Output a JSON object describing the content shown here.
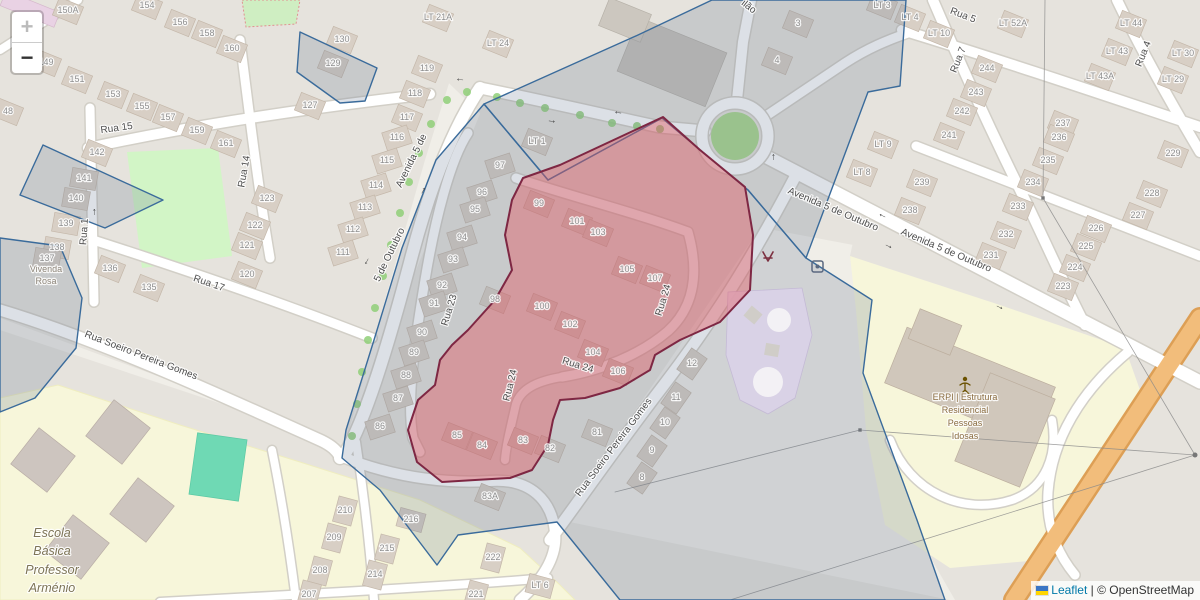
{
  "controls": {
    "zoom_in": "+",
    "zoom_out": "−"
  },
  "attribution": {
    "leaflet": "Leaflet",
    "sep": " | ",
    "osm": "© OpenStreetMap"
  },
  "colors": {
    "red_fill": "#e2565f",
    "red_stroke": "#7e2743",
    "blue_stroke": "#3a6b9b",
    "blue_fill": "rgba(96,115,140,0.22)",
    "purple_fill": "#dbd3e8",
    "link": "#0078A8",
    "house_number_text": "#8f8f8f",
    "street_text": "#4e4e4e"
  },
  "house_numbers": [
    [
      "150A",
      68,
      10,
      22
    ],
    [
      "154",
      147,
      5,
      22
    ],
    [
      "156",
      180,
      22,
      22
    ],
    [
      "158",
      207,
      33,
      22
    ],
    [
      "160",
      232,
      48,
      22
    ],
    [
      "149",
      46,
      62,
      22
    ],
    [
      "151",
      77,
      79,
      22
    ],
    [
      "153",
      113,
      94,
      22
    ],
    [
      "155",
      142,
      106,
      22
    ],
    [
      "157",
      168,
      117,
      22
    ],
    [
      "159",
      197,
      130,
      22
    ],
    [
      "161",
      226,
      143,
      22
    ],
    [
      "48",
      8,
      111,
      22
    ],
    [
      "142",
      97,
      152,
      22
    ],
    [
      "141",
      84,
      178,
      10
    ],
    [
      "140",
      76,
      198,
      10
    ],
    [
      "139",
      66,
      223,
      10
    ],
    [
      "138",
      57,
      247,
      10
    ],
    [
      "137",
      47,
      258,
      10
    ],
    [
      "136",
      110,
      268,
      22
    ],
    [
      "135",
      149,
      287,
      22
    ],
    [
      "123",
      267,
      198,
      22
    ],
    [
      "122",
      255,
      225,
      22
    ],
    [
      "121",
      247,
      245,
      22
    ],
    [
      "120",
      247,
      274,
      22
    ],
    [
      "130",
      342,
      39,
      22
    ],
    [
      "129",
      333,
      63,
      22
    ],
    [
      "127",
      310,
      105,
      22
    ],
    [
      "LT 21A",
      438,
      17,
      22
    ],
    [
      "LT 24",
      498,
      43,
      22
    ],
    [
      "119",
      427,
      68,
      22
    ],
    [
      "118",
      415,
      93,
      22
    ],
    [
      "117",
      407,
      117,
      22
    ],
    [
      "116",
      397,
      137,
      -18
    ],
    [
      "115",
      387,
      160,
      -18
    ],
    [
      "114",
      376,
      185,
      -18
    ],
    [
      "113",
      365,
      207,
      -18
    ],
    [
      "112",
      353,
      229,
      -18
    ],
    [
      "111",
      343,
      252,
      -18
    ],
    [
      "LT 1",
      537,
      141,
      22
    ],
    [
      "3",
      798,
      23,
      22
    ],
    [
      "4",
      777,
      60,
      22
    ],
    [
      "LT 3",
      882,
      5,
      22
    ],
    [
      "LT 9",
      883,
      144,
      22
    ],
    [
      "LT 8",
      862,
      172,
      22
    ],
    [
      "97",
      500,
      165,
      -18
    ],
    [
      "96",
      482,
      192,
      -18
    ],
    [
      "95",
      475,
      209,
      -18
    ],
    [
      "94",
      462,
      237,
      -18
    ],
    [
      "93",
      453,
      259,
      -18
    ],
    [
      "92",
      442,
      285,
      -18
    ],
    [
      "91",
      434,
      303,
      -18
    ],
    [
      "90",
      422,
      332,
      -18
    ],
    [
      "89",
      414,
      352,
      -18
    ],
    [
      "88",
      406,
      375,
      -18
    ],
    [
      "87",
      398,
      398,
      -18
    ],
    [
      "86",
      380,
      426,
      -18
    ],
    [
      "99",
      539,
      203,
      22
    ],
    [
      "101",
      577,
      221,
      22
    ],
    [
      "103",
      598,
      232,
      22
    ],
    [
      "105",
      627,
      269,
      22
    ],
    [
      "107",
      655,
      278,
      22
    ],
    [
      "98",
      495,
      299,
      22
    ],
    [
      "100",
      542,
      306,
      22
    ],
    [
      "102",
      570,
      324,
      22
    ],
    [
      "104",
      593,
      352,
      22
    ],
    [
      "106",
      618,
      371,
      22
    ],
    [
      "85",
      457,
      435,
      22
    ],
    [
      "84",
      482,
      445,
      22
    ],
    [
      "83",
      523,
      440,
      22
    ],
    [
      "82",
      550,
      448,
      22
    ],
    [
      "81",
      597,
      432,
      22
    ],
    [
      "83A",
      490,
      496,
      22
    ],
    [
      "12",
      692,
      363,
      -55
    ],
    [
      "11",
      676,
      397,
      -55
    ],
    [
      "10",
      665,
      422,
      -55
    ],
    [
      "9",
      652,
      450,
      -55
    ],
    [
      "8",
      642,
      477,
      -55
    ],
    [
      "244",
      987,
      68,
      22
    ],
    [
      "243",
      976,
      92,
      22
    ],
    [
      "242",
      962,
      111,
      22
    ],
    [
      "241",
      949,
      135,
      22
    ],
    [
      "239",
      922,
      182,
      22
    ],
    [
      "238",
      910,
      210,
      22
    ],
    [
      "237",
      1063,
      123,
      22
    ],
    [
      "236",
      1059,
      137,
      22
    ],
    [
      "235",
      1048,
      160,
      22
    ],
    [
      "234",
      1033,
      182,
      22
    ],
    [
      "233",
      1018,
      206,
      22
    ],
    [
      "232",
      1006,
      234,
      22
    ],
    [
      "231",
      991,
      255,
      22
    ],
    [
      "229",
      1173,
      153,
      22
    ],
    [
      "228",
      1152,
      193,
      22
    ],
    [
      "227",
      1138,
      215,
      22
    ],
    [
      "226",
      1096,
      228,
      22
    ],
    [
      "225",
      1086,
      246,
      22
    ],
    [
      "224",
      1075,
      267,
      22
    ],
    [
      "223",
      1063,
      286,
      22
    ],
    [
      "LT 4",
      910,
      17,
      22
    ],
    [
      "LT 10",
      939,
      33,
      22
    ],
    [
      "LT 52A",
      1013,
      23,
      22
    ],
    [
      "LT 44",
      1131,
      23,
      22
    ],
    [
      "LT 43",
      1117,
      51,
      22
    ],
    [
      "LT 43A",
      1100,
      76,
      22
    ],
    [
      "LT 30",
      1183,
      53,
      22
    ],
    [
      "LT 29",
      1173,
      79,
      22
    ],
    [
      "210",
      345,
      510,
      -75
    ],
    [
      "209",
      334,
      537,
      -75
    ],
    [
      "208",
      320,
      570,
      -75
    ],
    [
      "207",
      309,
      594,
      -75
    ],
    [
      "216",
      411,
      519,
      15
    ],
    [
      "215",
      387,
      548,
      -75
    ],
    [
      "214",
      375,
      574,
      -75
    ],
    [
      "222",
      493,
      557,
      -75
    ],
    [
      "221",
      476,
      594,
      -75
    ],
    [
      "LT 6",
      540,
      585,
      15
    ]
  ],
  "street_labels": [
    [
      "Rua 15",
      117,
      131,
      -8
    ],
    [
      "Rua 14",
      247,
      172,
      -80
    ],
    [
      "Rua 1",
      87,
      232,
      -86
    ],
    [
      "Rua 17",
      208,
      286,
      19
    ],
    [
      "Rua Soeiro Pereira Gomes",
      140,
      358,
      21
    ],
    [
      "Rua Soeiro Pereira Gomes",
      616,
      449,
      -53
    ],
    [
      "Avenida 5 de",
      414,
      162,
      -64
    ],
    [
      "5 de Outubro",
      392,
      256,
      -64
    ],
    [
      "Rua 23",
      452,
      311,
      -73
    ],
    [
      "Rua 24",
      666,
      301,
      -73
    ],
    [
      "Rua 24",
      577,
      368,
      17
    ],
    [
      "Rua 24",
      513,
      386,
      -76
    ],
    [
      "Avenida 5 de Outubro",
      832,
      212,
      23
    ],
    [
      "Avenida 5 de Outubro",
      945,
      253,
      23
    ],
    [
      "Rua 5",
      962,
      18,
      21
    ],
    [
      "Rua 7",
      961,
      61,
      -68
    ],
    [
      "Rua 4",
      1146,
      55,
      -68
    ],
    [
      "ilão",
      747,
      9,
      38
    ]
  ],
  "pois": {
    "vivenda": {
      "lines": [
        "Vivenda",
        "Rosa"
      ],
      "x": 46,
      "y": [
        272,
        284
      ],
      "size": 9,
      "color": "#8d8579"
    },
    "escola": {
      "lines": [
        "Escola",
        "Básica",
        "Professor",
        "Arménio"
      ],
      "x": 52,
      "y": [
        537,
        555,
        574,
        592
      ],
      "size": 12.5,
      "color": "#7d7456"
    },
    "erpi": {
      "lines": [
        "ERPI | Estrutura",
        "Residencial",
        "Pessoas",
        "Idosas"
      ],
      "x": 965,
      "y": [
        400,
        413,
        426,
        439
      ],
      "size": 9,
      "color": "#8a6c40"
    }
  }
}
